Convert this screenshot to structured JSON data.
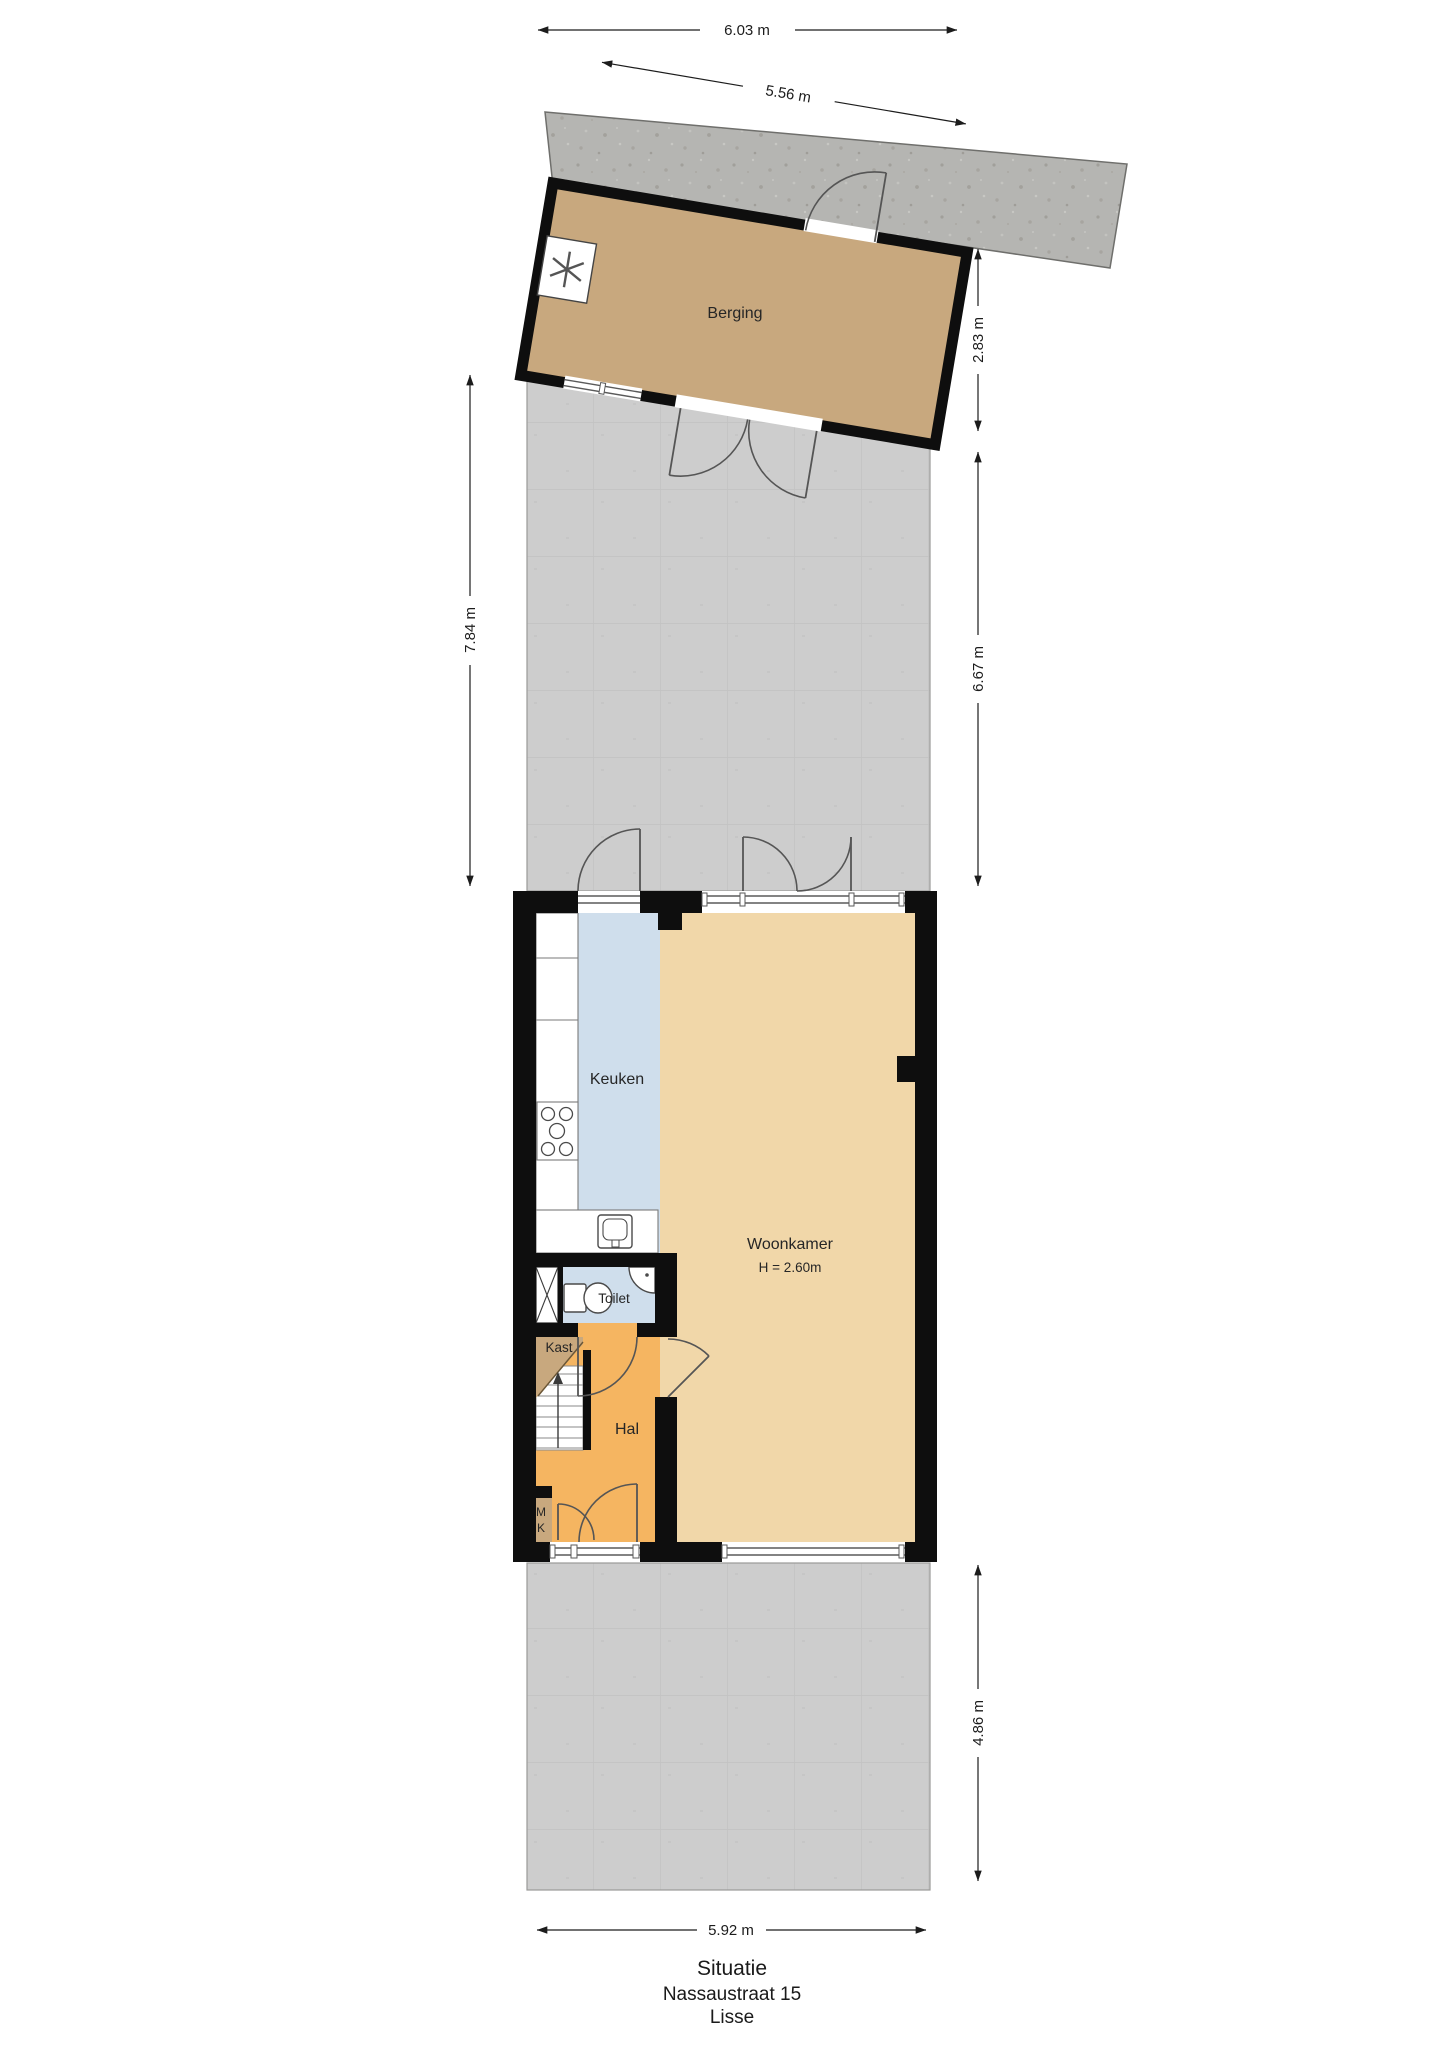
{
  "plan": {
    "title_block": {
      "line1": "Situatie",
      "line2": "Nassaustraat 15",
      "line3": "Lisse"
    },
    "rooms": {
      "berging": "Berging",
      "keuken": "Keuken",
      "woonkamer": "Woonkamer",
      "woonkamer_height": "H = 2.60m",
      "toilet": "Toilet",
      "kast": "Kast",
      "hal": "Hal",
      "meter_m": "M",
      "meter_k": "K"
    },
    "dimensions": {
      "top": "6.03 m",
      "top_slanted": "5.56 m",
      "right_upper": "2.83 m",
      "left": "7.84 m",
      "right_middle": "6.67 m",
      "right_lower": "4.86 m",
      "bottom": "5.92 m"
    },
    "icons": {
      "fan": "asterisk-fan-symbol",
      "stairs_up": "arrow-up",
      "dimension_arrows": "double-headed-arrow"
    },
    "colors": {
      "wall": "#0e0e0e",
      "berging_floor": "#c8a87e",
      "woonkamer_floor": "#f1d7a9",
      "hal_floor": "#f5b561",
      "keuken_floor": "#cfdeec",
      "toilet_floor": "#cfdeec",
      "kast_floor": "#c8a87e",
      "garden_tiles": "#cdcdcd",
      "concrete_slab": "#b5b5b2",
      "dimension_text": "#1c1c1c"
    }
  }
}
